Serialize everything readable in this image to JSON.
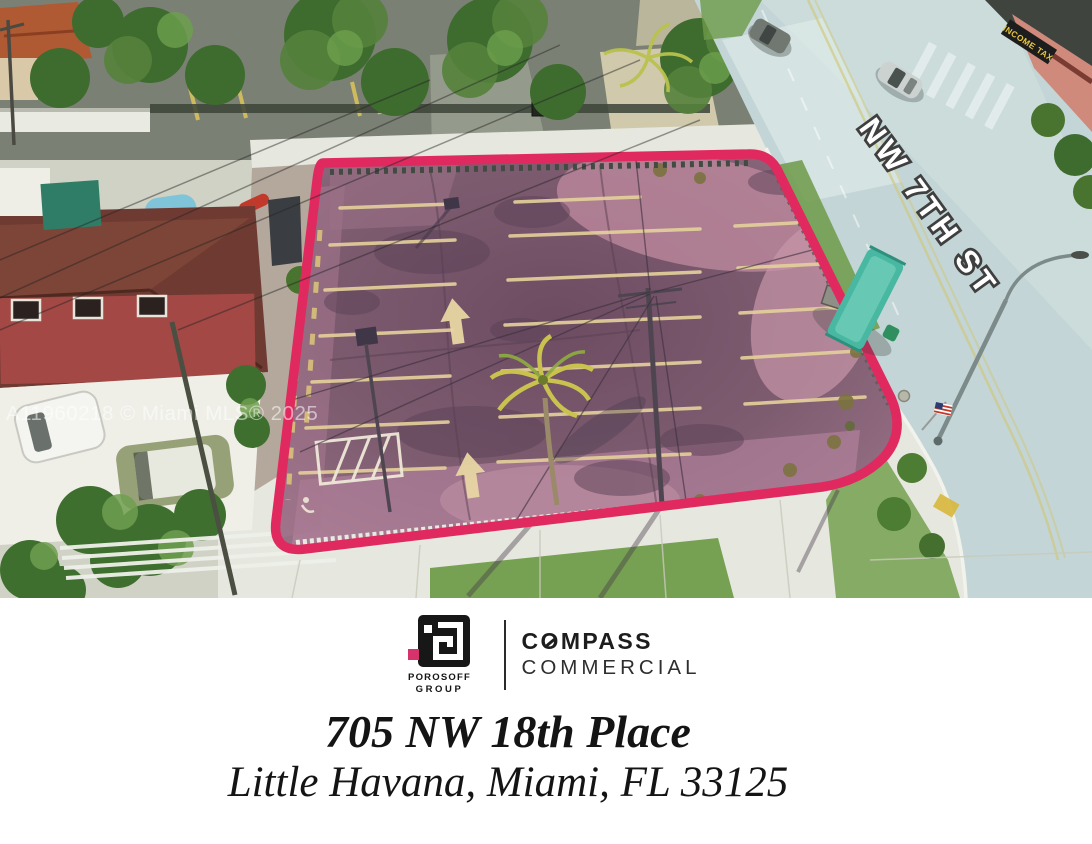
{
  "colors": {
    "outline_pink": "#e02a5f",
    "accent_pink": "#d6336c",
    "road": "#c3d5d6",
    "lot_asphalt": "#7e5c70"
  },
  "photo": {
    "street_label": "NW 7TH ST",
    "watermark": "A11960218 © Miami MLS® 2025",
    "storefront_sign": "INCOME TAX"
  },
  "footer": {
    "porosoff_group": {
      "name_line1": "POROSOFF",
      "name_line2": "GROUP"
    },
    "compass": {
      "word_pre_o": "C",
      "word_o": "O",
      "word_post_o": "MPASS",
      "line2": "COMMERCIAL"
    },
    "address": {
      "line1": "705 NW 18th Place",
      "line2": "Little Havana, Miami, FL 33125"
    }
  }
}
